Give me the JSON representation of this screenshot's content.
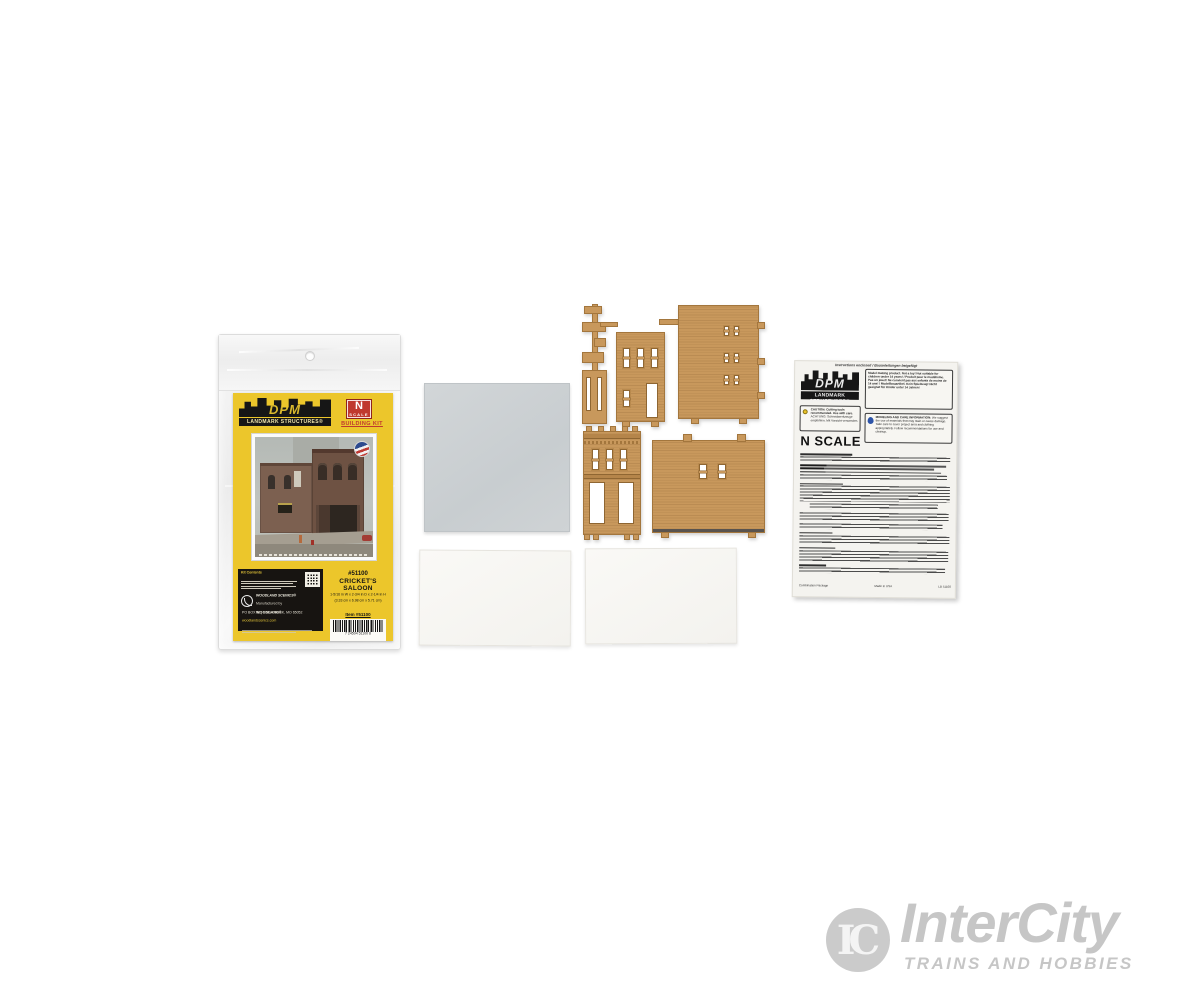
{
  "colors": {
    "card_yellow": "#ecc62b",
    "badge_red": "#c0392f",
    "plastic_tan": "#c8985c",
    "sheet_gray": "#cdd1d4",
    "watermark_gray": "#c6c6c6"
  },
  "package": {
    "brand": {
      "name": "DPM",
      "tagline": "LANDMARK STRUCTURES®"
    },
    "scale_badge": {
      "letter": "N",
      "word": "SCALE"
    },
    "kit_type": "BUILDING KIT",
    "kit_number": "#51100",
    "kit_name_line1": "CRICKET'S",
    "kit_name_line2": "SALOON",
    "dims_in": "1-5/16 in W x 2-3/4 in D x 2-1/4 in H",
    "dims_cm": "(3.33 cm x 6.98 cm x 5.71 cm)",
    "item_label": "Item #51100",
    "barcode_digits": "7 24504 51100 8",
    "contents_title": "Kit Contents",
    "maker": {
      "line1": "WOODLAND SCENICS®",
      "line2": "Manufactured by",
      "line3": "WOODLAND®",
      "address": "PO BOX 98 | LINN CREEK, MO 65052",
      "website": "woodlandscenics.com"
    }
  },
  "instructions": {
    "header": "Instructions enclosed / Bauanleitungen beigefügt",
    "brand": {
      "name": "DPM",
      "tagline": "LANDMARK STRUCTURES®"
    },
    "warning": "Model making product. Not a toy! Not suitable for children under 14 years! / Produit pour le modélisme. Pas un jouet! Ne convient pas aux enfants de moins de 14 ans! / Modellbauartikel. Kein Spielzeug! Nicht geeignet für Kinder unter 14 Jahren!",
    "caution_en": "CAUTION: Cutting tools recommended. Use with care.",
    "caution_de": "ACHTUNG: Schneidwerkzeuge empfohlen. Mit Vorsicht verwenden.",
    "care_title": "MODELING AND CARE INFORMATION:",
    "care_body": "We suggest the use of materials that may stain or cause damage. Take care to cover project area and clothing appropriately. Follow recommendations for use and cleanup.",
    "scale_heading": "N SCALE",
    "footer_left": "Combination Package",
    "footer_center": "Made in USA",
    "footer_right": "LB 51100"
  },
  "watermark": {
    "monogram": "IC",
    "name": "InterCity",
    "tagline": "TRAINS AND HOBBIES"
  }
}
